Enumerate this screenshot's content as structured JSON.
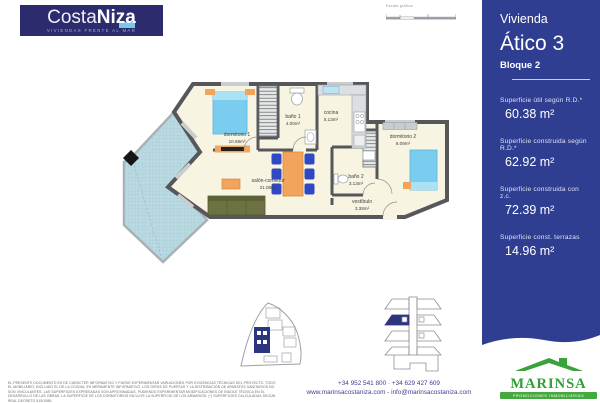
{
  "brand": {
    "name_regular": "Costa",
    "name_bold": "Niza",
    "tagline": "VIVIENDAS FRENTE AL MAR"
  },
  "scale_bar": {
    "label": "Escala gráfica"
  },
  "panel": {
    "heading_small": "Vivienda",
    "heading_large": "Ático 3",
    "subheading": "Bloque 2",
    "areas": [
      {
        "label": "Superficie útil según R.D.*",
        "value": "60.38 m²"
      },
      {
        "label": "Superficie construida según R.D.*",
        "value": "62.92 m²"
      },
      {
        "label": "Superficie construida con z.c.",
        "value": "72.39 m²"
      },
      {
        "label": "Superficie const. terrazas",
        "value": "14.96 m²"
      }
    ]
  },
  "plan": {
    "rooms": [
      {
        "name": "dormitorio 1",
        "area": "10.68m²"
      },
      {
        "name": "baño 1",
        "area": "4.00m²"
      },
      {
        "name": "cocina",
        "area": "5.13m²"
      },
      {
        "name": "dormitorio 2",
        "area": "8.09m²"
      },
      {
        "name": "salón-comedor",
        "area": "21.08m²"
      },
      {
        "name": "baño 2",
        "area": "3.13m²"
      },
      {
        "name": "vestíbulo",
        "area": "3.38m²"
      }
    ]
  },
  "footer": {
    "phones": "+34 952 541 800 · +34 629 427 609",
    "web": "www.marinsacostaniza.com - info@marinsacostaniza.com",
    "disclaimer": "EL PRESENTE DOCUMENTO ES DE CARÁCTER INFORMATIVO Y PUEDE EXPERIMENTAR VARIACIONES POR EXIGENCIAS TÉCNICAS DEL PROYECTO. TODO EL MOBILIARIO, INCLUIDO EL DE LA COCINA, ES MERAMENTE INFORMATIVO. LOS GIROS DE PUERTAS Y LA DISTRIBUCIÓN DE APARATOS SANITARIOS NO SON VINCULANTES. LAS SUPERFICIES EXPRESADAS SON APROXIMADAS, PUDIENDO EXPERIMENTAR MODIFICACIONES DE ÍNDOLE TÉCNICA EN EL DESARROLLO DE LAS OBRAS. LA SUPERFICIE DE LOS DORMITORIOS INCLUYE LA SUPERFICIE DE LOS ARMARIOS. (*) SUPERFICIES CALCULADAS SEGÚN REAL DECRETO 515/1989.",
    "marinsa_name": "MARINSA",
    "marinsa_tagline": "PROMOCIONES INMOBILIARIAS"
  },
  "colors": {
    "logo_navy": "#2c2b6d",
    "panel_blue": "#303e92",
    "accent_lightblue": "#7cc6ea",
    "marinsa_green": "#3aa23a",
    "terrace_blue": "#badae2",
    "wall_gray": "#55575b",
    "floor_cream": "#f8f4e2",
    "furniture_orange": "#f2a45c",
    "bed_blue": "#7bcdef",
    "chair_blue": "#2f49c4",
    "sofa_olive": "#6d7244"
  }
}
